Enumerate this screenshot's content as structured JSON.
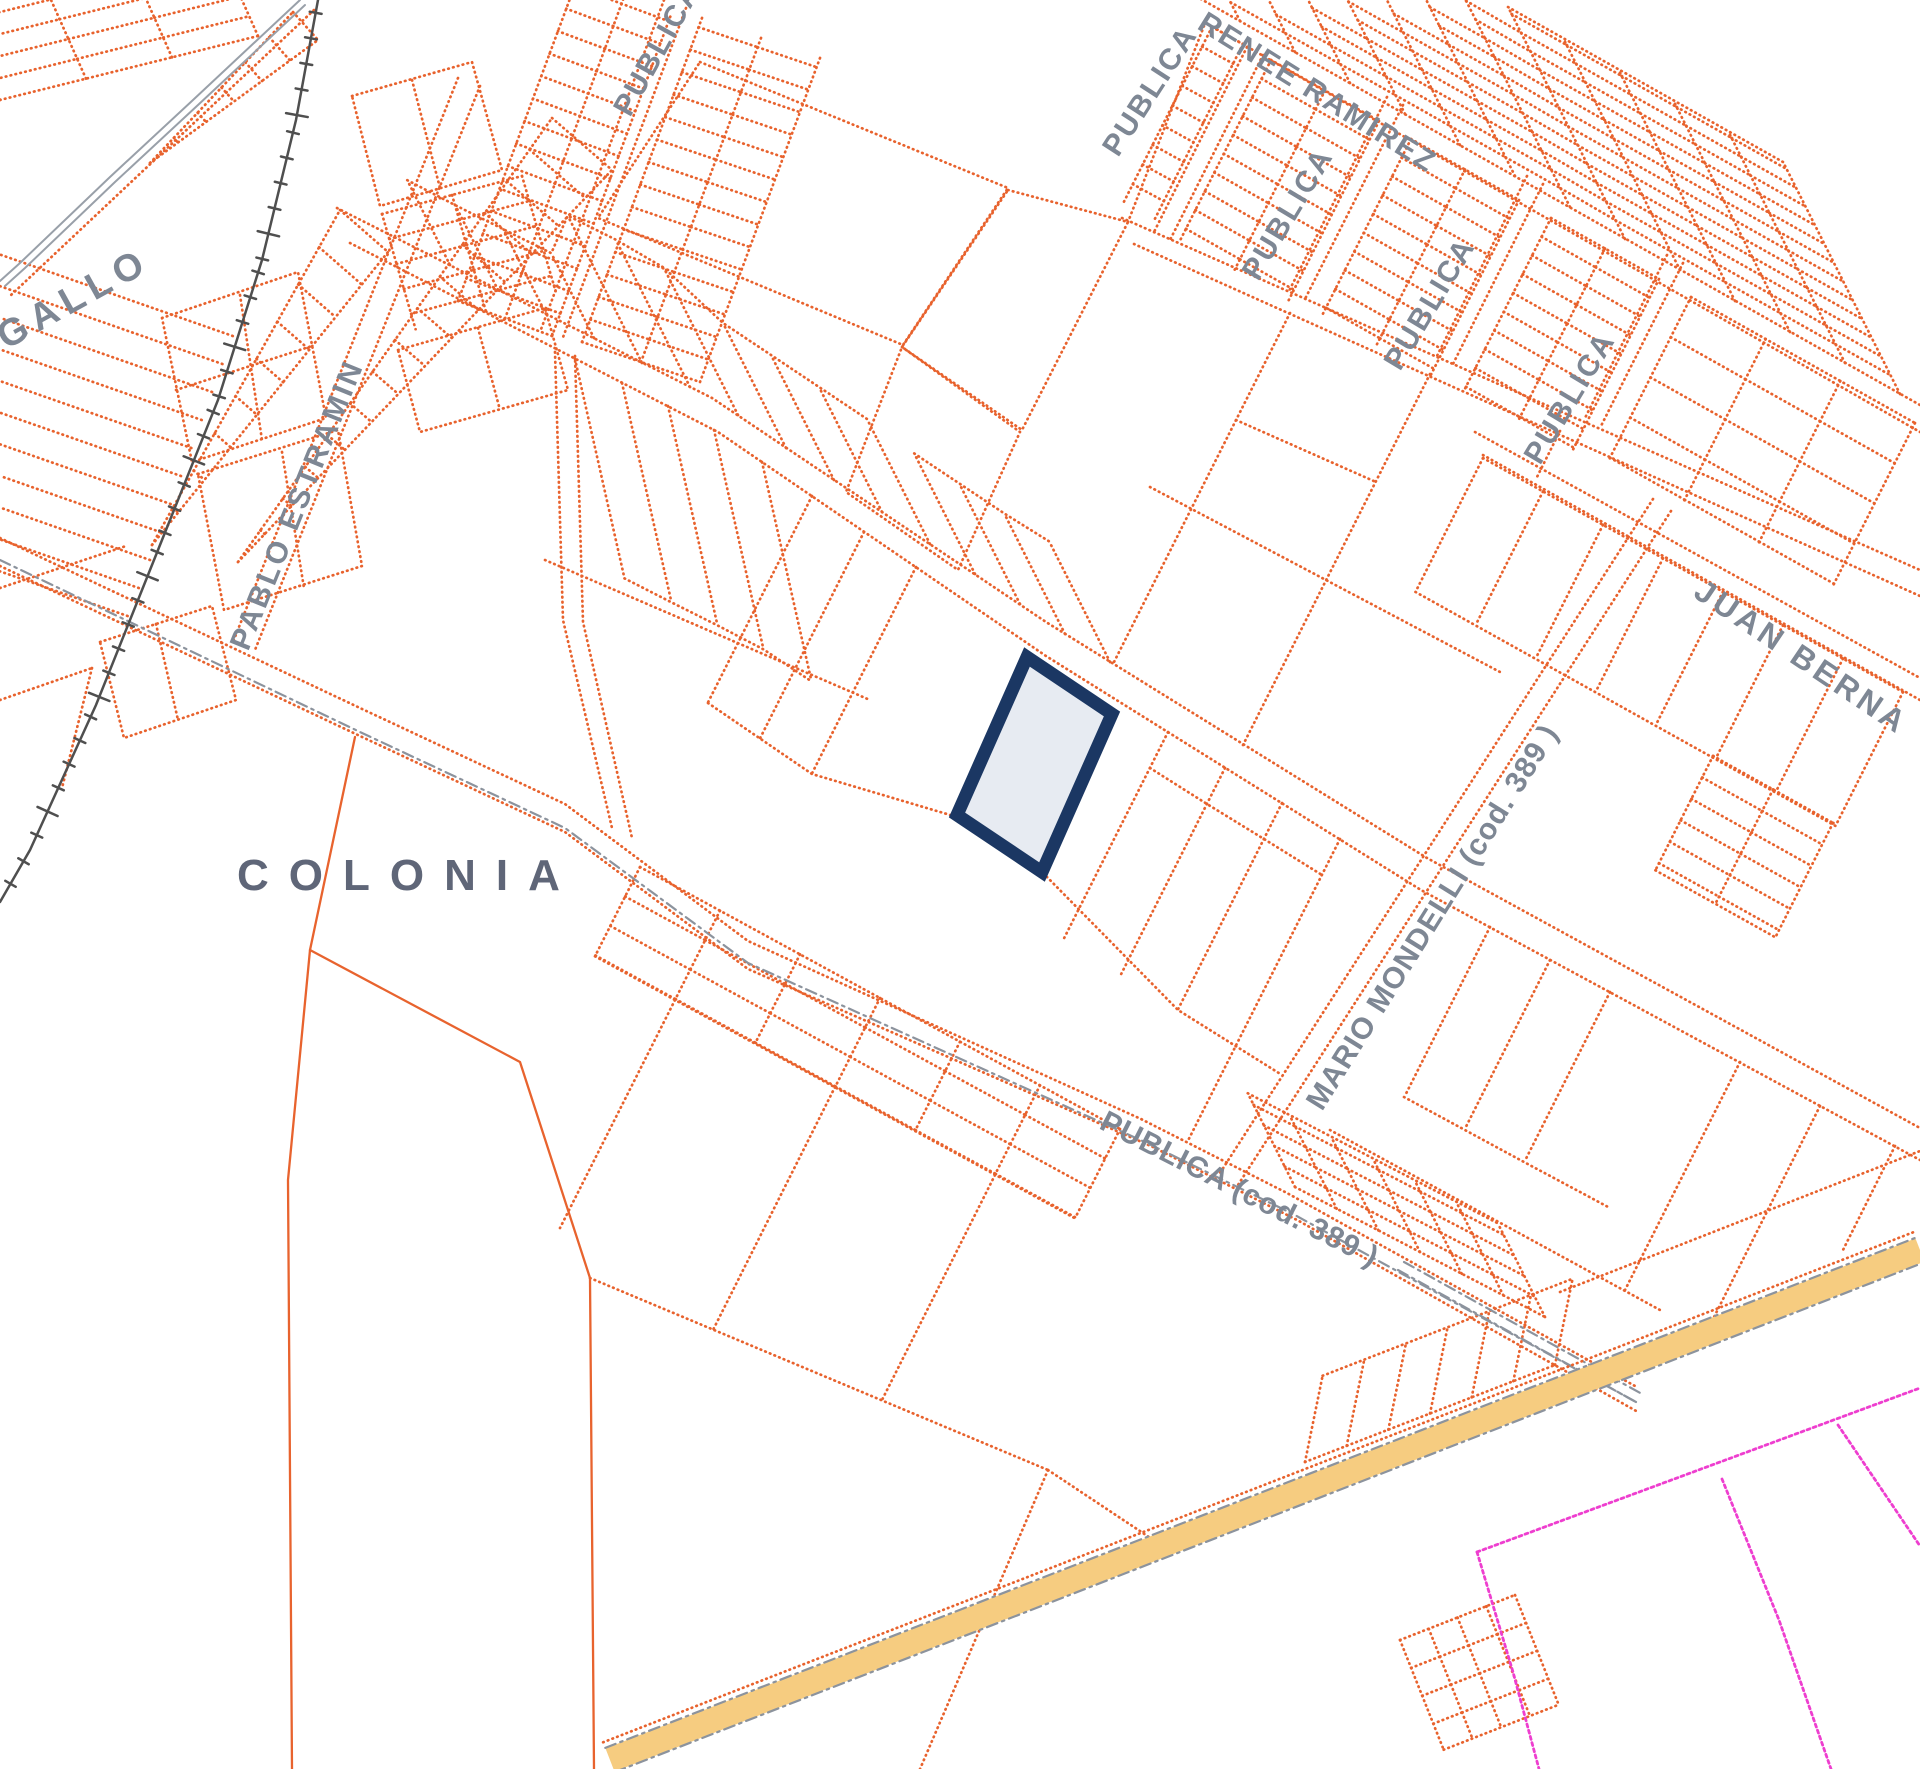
{
  "map": {
    "kind": "cadastral parcel map",
    "background": "#ffffff",
    "colors": {
      "parcel_line": "#E8622D",
      "secondary_road": "#99A0A9",
      "railway": "#4F4F4F",
      "highway_fill": "#F6CC80",
      "admin_boundary": "#EE3ECF",
      "street_label": "#7E8794",
      "area_label": "#5F6678",
      "highlight_stroke": "#1B3763",
      "highlight_fill": "#E7EBF2"
    },
    "street_labels": [
      {
        "text": "GALLO",
        "x": 6,
        "y": 350,
        "rot": -29,
        "fs": 38,
        "ls": 7
      },
      {
        "text": "PABLO  ESTRAMIN",
        "x": 248,
        "y": 652,
        "rot": -68,
        "fs": 30,
        "ls": 3
      },
      {
        "text": "PUBLICA",
        "x": 630,
        "y": 118,
        "rot": -61,
        "fs": 30,
        "ls": 2
      },
      {
        "text": "PUBLICA",
        "x": 1118,
        "y": 158,
        "rot": -57,
        "fs": 30,
        "ls": 2
      },
      {
        "text": "PUBLICA",
        "x": 1258,
        "y": 282,
        "rot": -59,
        "fs": 30,
        "ls": 2
      },
      {
        "text": "PUBLICA",
        "x": 1400,
        "y": 372,
        "rot": -59,
        "fs": 30,
        "ls": 2
      },
      {
        "text": "PUBLICA",
        "x": 1540,
        "y": 466,
        "rot": -59,
        "fs": 30,
        "ls": 2
      },
      {
        "text": "RENEE  RAMIREZ",
        "x": 1196,
        "y": 28,
        "rot": 32,
        "fs": 30,
        "ls": 2
      },
      {
        "text": "JUAN  BERNA",
        "x": 1692,
        "y": 596,
        "rot": 34,
        "fs": 32,
        "ls": 4
      },
      {
        "text": "MARIO  MONDELLI (cod. 389 )",
        "x": 1322,
        "y": 1112,
        "rot": -58,
        "fs": 30,
        "ls": 1
      },
      {
        "text": "PUBLICA (cod. 389 )",
        "x": 1098,
        "y": 1128,
        "rot": 27,
        "fs": 30,
        "ls": 1
      }
    ],
    "area_labels": [
      {
        "text": "COLONIA",
        "x": 237,
        "y": 890,
        "rot": 0,
        "fs": 44,
        "ls": 20
      }
    ],
    "highlighted_parcel": {
      "points": "1027,657 1112,714 1042,872 957,815",
      "fill": "#E7EBF2",
      "stroke": "#1B3763",
      "stroke_width": 13
    }
  }
}
